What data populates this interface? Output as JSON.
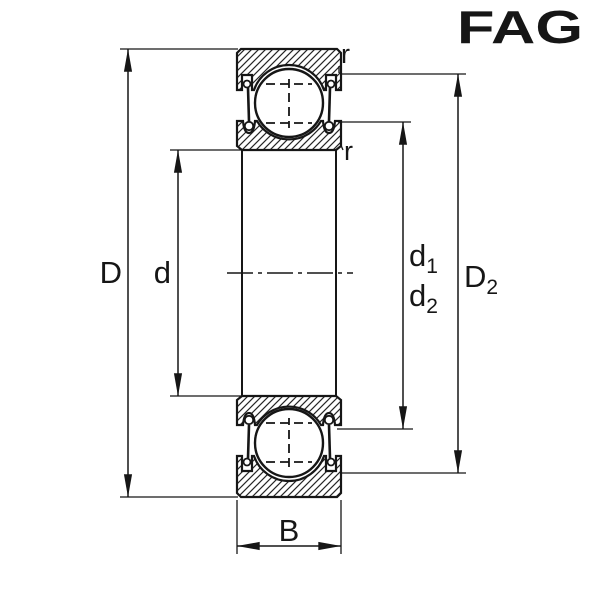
{
  "colors": {
    "line": "#161616",
    "logo_red": "#E2001A",
    "background": "#ffffff"
  },
  "logo": {
    "text": "FAG"
  },
  "drawing": {
    "dimension_labels": {
      "D": {
        "text": "D"
      },
      "d": {
        "text": "d"
      },
      "d1": {
        "base": "d",
        "sub": "1"
      },
      "d2": {
        "base": "d",
        "sub": "2"
      },
      "D2": {
        "base": "D",
        "sub": "2"
      },
      "B": {
        "text": "B"
      },
      "r_outer": {
        "text": "r"
      },
      "r_inner": {
        "text": "r"
      }
    }
  }
}
